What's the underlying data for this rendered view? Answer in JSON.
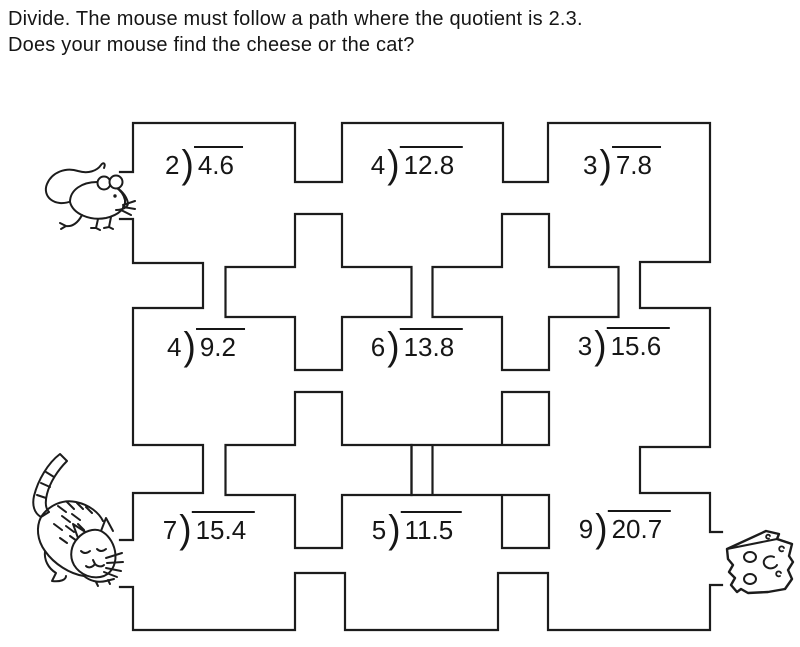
{
  "instructions": {
    "line1": "Divide. The mouse must follow a path where the quotient is 2.3.",
    "line2": "Does your mouse find the cheese or the cat?"
  },
  "notation": {
    "division_bracket": ")"
  },
  "problems": [
    {
      "divisor": "2",
      "dividend": "4.6"
    },
    {
      "divisor": "4",
      "dividend": "12.8"
    },
    {
      "divisor": "3",
      "dividend": "7.8"
    },
    {
      "divisor": "4",
      "dividend": "9.2"
    },
    {
      "divisor": "6",
      "dividend": "13.8"
    },
    {
      "divisor": "3",
      "dividend": "15.6"
    },
    {
      "divisor": "7",
      "dividend": "15.4"
    },
    {
      "divisor": "5",
      "dividend": "11.5"
    },
    {
      "divisor": "9",
      "dividend": "20.7"
    }
  ],
  "illustrations": {
    "mouse": "mouse-drawing",
    "cat": "cat-drawing",
    "cheese": "cheese-wedge-drawing"
  },
  "colors": {
    "ink": "#1c1c1c",
    "paper": "#ffffff"
  }
}
